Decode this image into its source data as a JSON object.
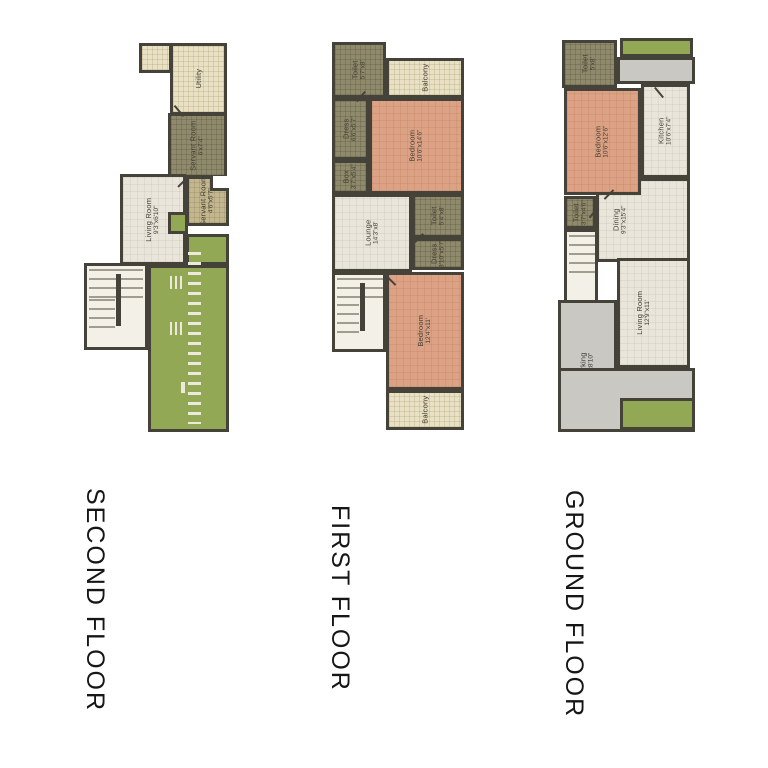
{
  "palette": {
    "wall": "#45423a",
    "floor": "#e9e5da",
    "bedroom": "#dba285",
    "service": "#8f8a6c",
    "servant": "#c3b78f",
    "balcony": "#e9e1c6",
    "lawn": "#93a854",
    "paving": "#c9c8c3",
    "stair": "#f3f0e8",
    "label": "#403e35",
    "title": "#161616"
  },
  "floors": {
    "second": {
      "title": "SECOND FLOOR",
      "rooms": {
        "utility": {
          "name": "Utility",
          "dims": ""
        },
        "servant1": {
          "name": "Servant Room",
          "dims": "6'x7'4\""
        },
        "servant2": {
          "name": "Servant Room",
          "dims": "4'6\"x5'7\""
        },
        "living": {
          "name": "Living Room",
          "dims": "9'3\"x6'10\""
        }
      }
    },
    "first": {
      "title": "FIRST FLOOR",
      "rooms": {
        "toilet1": {
          "name": "Toilet",
          "dims": "5'7\"x8'"
        },
        "balcony1": {
          "name": "Balcony",
          "dims": ""
        },
        "dress1": {
          "name": "Dress",
          "dims": "6'6\"x5'7\""
        },
        "box": {
          "name": "Box",
          "dims": "3'7\"x5'4\""
        },
        "bedroom1": {
          "name": "Bedroom",
          "dims": "10'6\"x14'6\""
        },
        "lounge": {
          "name": "Lounge",
          "dims": "14'3\"x8'"
        },
        "toilet2": {
          "name": "Toilet",
          "dims": "5'4\"x8'"
        },
        "dress2": {
          "name": "Dress",
          "dims": "3'10\"x5'7\""
        },
        "bedroom2": {
          "name": "Bedroom",
          "dims": "12'4\"x11'"
        },
        "balcony2": {
          "name": "Balcony",
          "dims": ""
        }
      }
    },
    "ground": {
      "title": "GROUND FLOOR",
      "rooms": {
        "toilet1": {
          "name": "Toilet",
          "dims": "5'x8'"
        },
        "bedroom": {
          "name": "Bedroom",
          "dims": "10'6\"x12'6\""
        },
        "kitchen": {
          "name": "Kitchen",
          "dims": "10'6\"x7'4\""
        },
        "toilet2": {
          "name": "Toilet",
          "dims": "3'7\"x4'6\""
        },
        "dining": {
          "name": "Dining",
          "dims": "9'3\"x15'4\""
        },
        "living": {
          "name": "Living Room",
          "dims": "12'9\"x11'"
        },
        "parking": {
          "name": "Parking",
          "dims": "14'x8'10\""
        }
      }
    }
  }
}
